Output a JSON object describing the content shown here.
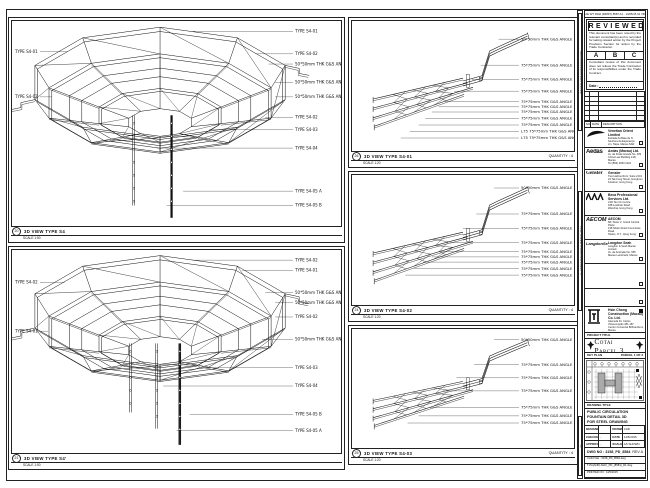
{
  "panels": {
    "p1": {
      "num": "20",
      "title": "3D VIEW TYPE S4",
      "scale": "SCALE 1:50",
      "right_labels": [
        "TYPE S4-01",
        "TYPE S4-02",
        "50*50mm THK G&S ANGLE",
        "50*50mm THK G&S ANGLE",
        "50*50mm THK G&S ANGLE",
        "TYPE S4-02",
        "TYPE S4-03",
        "TYPE S4-04",
        "TYPE S4-05 A",
        "TYPE S4-05 B"
      ],
      "left_labels": [
        "TYPE S4-01",
        "TYPE S4-02"
      ]
    },
    "p2": {
      "num": "21",
      "title": "3D VIEW TYPE S4'",
      "scale": "SCALE 1:50",
      "right_labels": [
        "TYPE S4-02",
        "TYPE S4-01",
        "50*50mm THK G&S ANGLE",
        "50*50mm THK G&S ANGLE",
        "TYPE S4-02",
        "50*50mm THK G&S ANGLE",
        "TYPE S4-03",
        "TYPE S4-04",
        "TYPE S4-05 B",
        "TYPE S4-05 A"
      ],
      "left_labels": [
        "TYPE S4-02",
        "TYPE S4-01"
      ]
    },
    "m1": {
      "num": "26",
      "title": "3D VIEW TYPE S4-01",
      "scale": "SCALE 1:20",
      "quantity": "QUANTITY : 4",
      "labels": [
        "50*50mm THK G&S ANGLE",
        "75*75mm THK G&S ANGLE",
        "75*75mm THK G&S ANGLE",
        "75*75mm THK G&S ANGLE",
        "75*75mm THK G&S ANGLE",
        "75*75mm THK G&S ANGLE",
        "75*75mm THK G&S ANGLE",
        "75*75mm THK G&S ANGLE",
        "75*75mm THK G&S ANGLE",
        "L75 75*75mm THK G&S ANGLE",
        "L75 75*75mm THK G&S ANGLE"
      ]
    },
    "m2": {
      "num": "24",
      "title": "3D VIEW TYPE S4-02",
      "scale": "SCALE 1:20",
      "quantity": "QUANTITY : 4",
      "labels": [
        "50*50mm THK G&S ANGLE",
        "75*75mm THK G&S ANGLE",
        "75*75mm THK G&S ANGLE",
        "75*75mm THK G&S ANGLE",
        "75*75mm THK G&S ANGLE",
        "75*75mm THK G&S ANGLE",
        "75*75mm THK G&S ANGLE",
        "75*75mm THK G&S ANGLE",
        "75*75mm THK G&S ANGLE"
      ]
    },
    "m3": {
      "num": "25",
      "title": "3D VIEW TYPE S4-03",
      "scale": "SCALE 1:20",
      "quantity": "QUANTITY : 4",
      "labels": [
        "50*50mm THK G&S ANGLE",
        "75*75mm THK G&S ANGLE",
        "75*75mm THK G&S ANGLE",
        "75*75mm THK G&S ANGLE",
        "75*75mm THK G&S ANGLE",
        "75*75mm THK G&S ANGLE",
        "75*75mm THK G&S ANGLE"
      ]
    }
  },
  "zone_notes": [
    "ISSUED FOR CONSTRUCTION",
    "© VENETIAN COTAI LIMITED 2014",
    "A1"
  ],
  "title_block": {
    "header_code": "AE WT 9342 (R4897) 8587 A1 · 14/05/15 01 VB",
    "reviewed": {
      "title": "REVIEWED",
      "para1": "This document has been noted by the relevant consultant(s) and is recorded for taking related action by the Project Provision Section for action by the Trade Contractor.",
      "options": [
        "A",
        "B",
        "C"
      ],
      "para2": "Consultant review of this document does not relieve the Trade Contractor of its responsibilities under the Trade Contract.",
      "date_label": "Date :"
    },
    "revision_footer": [
      "NO.",
      "DATE",
      "DESCRIPTION"
    ],
    "companies": [
      {
        "logo": "venetian",
        "logo_text": "",
        "name": "Venetian Orient Limited",
        "lines": [
          "Estrada da Baía de N. Senhora da Esperança",
          "s/n, Taipa, Macau SAR",
          "Tel (853) 2882 8888"
        ]
      },
      {
        "logo": "aedas",
        "logo_text": "Aedas",
        "name": "Aedas (Macau) Ltd.",
        "lines": [
          "Av. da Praia Grande No. 409",
          "China Law Building 21/F, Macau",
          "Tel (853) 2833 1022"
        ]
      },
      {
        "logo": "gensler",
        "logo_text": "Gensler",
        "name": "Gensler",
        "lines": [
          "Two Harbourfront, Suite 2101",
          "22 Tak Fung Street, Hunghom",
          "Kowloon, Hong Kong"
        ]
      },
      {
        "logo": "beca",
        "logo_text": "",
        "name": "Beca Professional Services Ltd.",
        "lines": [
          "21/F Siu On Centre",
          "188 Lockhart Road",
          "Wanchai, Hong Kong"
        ]
      },
      {
        "logo": "aecom",
        "logo_text": "AECOM",
        "name": "AECOM",
        "lines": [
          "8/F Tower 2, Grand Central Plaza",
          "138 Shatin Rural Committee Road",
          "Shatin, N.T., Hong Kong"
        ]
      },
      {
        "logo": "langdon",
        "logo_text": "LangdonSeah",
        "name": "Langdon Seah",
        "lines": [
          "Langdon & Seah Macau Limited",
          "Av. da Amizade No. 555",
          "Macau Landmark, Macau"
        ]
      },
      {
        "logo": "",
        "logo_text": "",
        "name": "",
        "lines": []
      },
      {
        "logo": "",
        "logo_text": "",
        "name": "",
        "lines": []
      }
    ],
    "contractor": {
      "name": "Hsin Chong Construction (Macau) Co. Ltd.",
      "lines": [
        "Alameda Dr. Carlos d'Assumpção 181-187",
        "Centro Comercial Brilhantismo, Macau"
      ]
    },
    "project": {
      "label": "PROJECT TITLE",
      "title": "Cotai Parcel 3"
    },
    "key_plan": {
      "label": "KEY PLAN",
      "parcel": "PARCEL 1 OF 3"
    },
    "drawing_title": {
      "label": "DRAWING TITLE",
      "lines": [
        "PUBLIC CIRCULATION",
        "FOUNTAIN DETAIL 3D",
        "FOR STEEL DRAWING"
      ]
    },
    "signoff": [
      [
        "DESIGNED",
        "",
        "DRAWN",
        "CAD"
      ],
      [
        "CHECKED",
        "-",
        "DATE",
        "14/5/2015"
      ],
      [
        "APPROVED",
        "-",
        "SCALE",
        "AS SHOWN"
      ]
    ],
    "dwg": {
      "label": "DWG NO :",
      "no": "3158_PD_8584",
      "rev": "REV A"
    },
    "cad_rows": [
      "CAD FILE : 3158_PD_8584.dwg",
      "T-PA(AND)-MAC_PD_(8584)_R1.dwg",
      "PRINTED ON : 14/5/2015"
    ]
  }
}
